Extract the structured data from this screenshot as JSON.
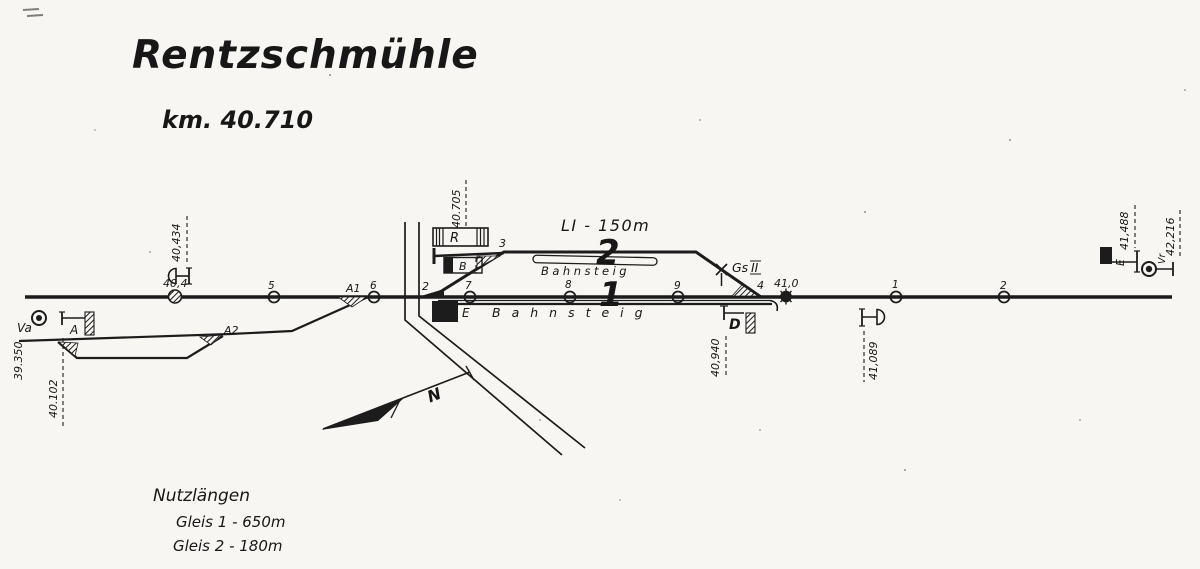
{
  "title": "Rentzschmühle",
  "km_heading": "km.  40.710",
  "colors": {
    "ink": "#1c1c1c",
    "paper": "#f7f6f2"
  },
  "north_label": "N",
  "tracks": {
    "track1": "1",
    "track2": "2",
    "loading_length": "LI  - 150m",
    "platform_between": "Bahnsteig",
    "platform_main": "Bahnsteig",
    "branch_km": "39.350"
  },
  "buildings": {
    "r": "R",
    "b": "B",
    "e": "E"
  },
  "switches": {
    "s2": "2",
    "s3": "3",
    "s4": "4",
    "a1": "A1",
    "a2": "A2"
  },
  "markers": {
    "m5": "5",
    "m6": "6",
    "m7": "7",
    "m8": "8",
    "m9": "9",
    "m1": "1",
    "m2": "2",
    "km404": "40,4",
    "km410": "41,0",
    "km40705": "40.705"
  },
  "signals": {
    "vorsignal_left_km": "40,434",
    "va": "Va",
    "a": "A",
    "a_km": "40.102",
    "d": "D",
    "d_km": "40,940",
    "gs": "Gs",
    "gs_num": "II",
    "vorsignal_right_km": "41,089",
    "e": "E",
    "e_km": "41,488",
    "vr": "Vr",
    "vr_km": "42,216"
  },
  "legend": {
    "heading": "Nutzlängen",
    "gleis1": "Gleis 1  -  650m",
    "gleis2": "Gleis 2  -  180m"
  }
}
